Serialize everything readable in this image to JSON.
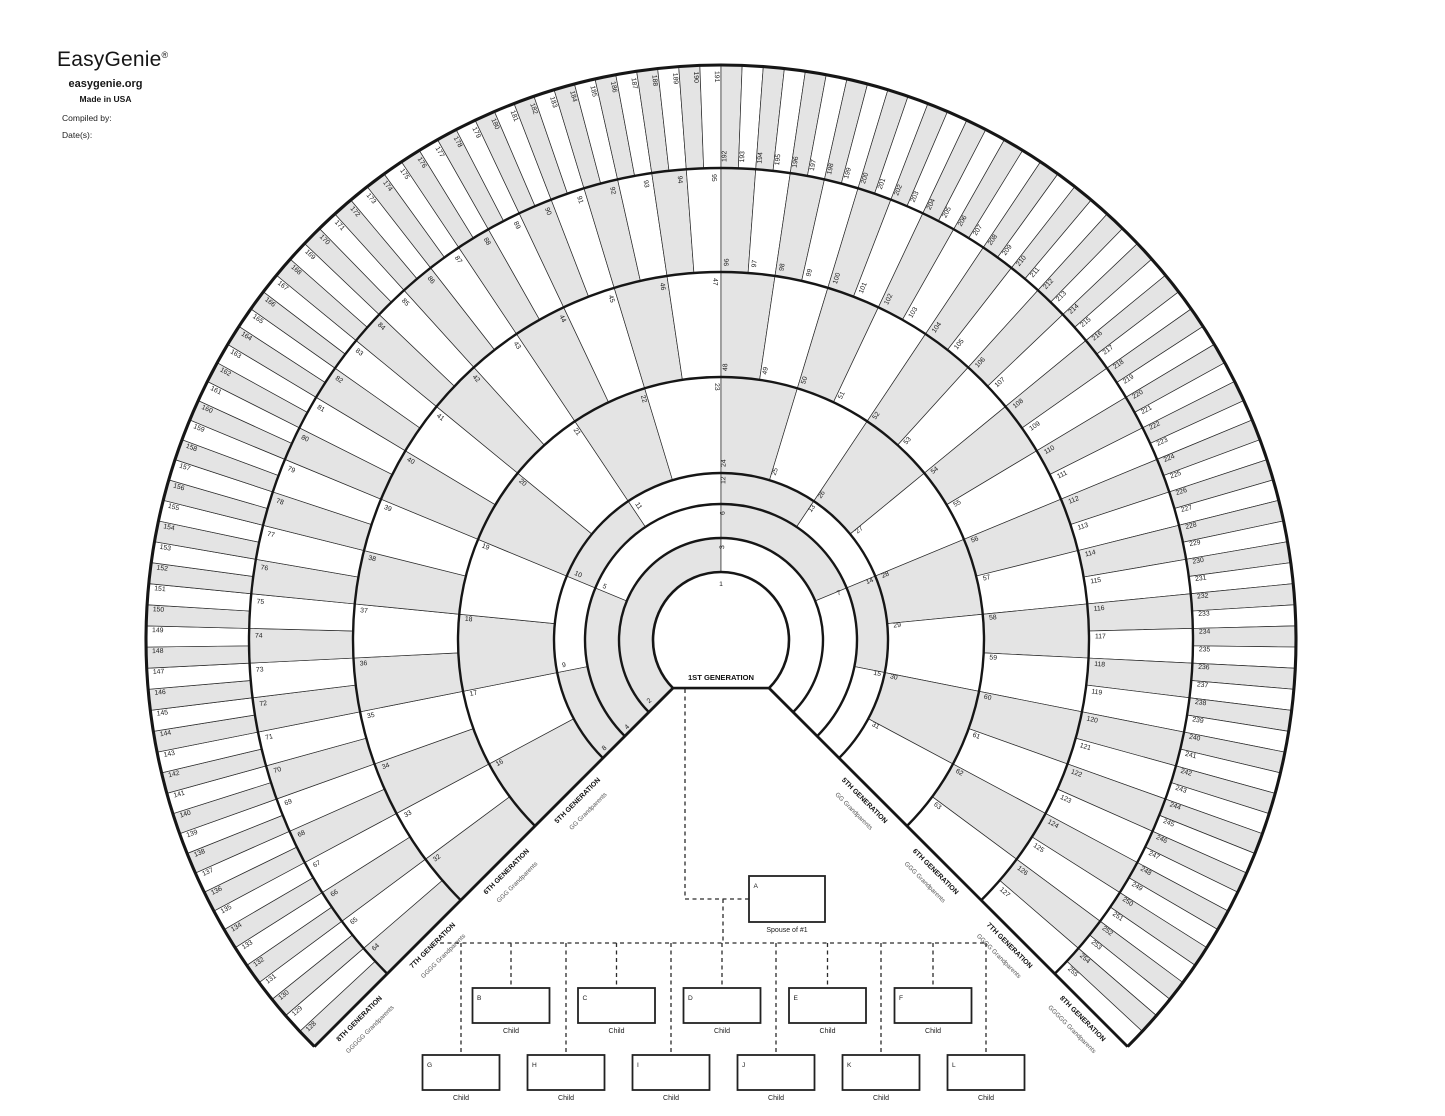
{
  "header": {
    "logo": "EasyGenie",
    "registered": "®",
    "site": "easygenie.org",
    "made_in": "Made in USA",
    "compiled_by": "Compiled by:",
    "dates": "Date(s):"
  },
  "fan": {
    "center_label": "1ST GENERATION",
    "center_number": "1",
    "colors": {
      "shade": "#e4e4e4",
      "line": "#161616",
      "subtext": "#555555"
    },
    "geometry": {
      "cx": 721,
      "cy": 640,
      "start_angle": 225,
      "end_angle": -45,
      "radii": [
        68,
        102,
        136,
        167,
        263,
        368,
        472,
        575
      ]
    },
    "rings": [
      {
        "generation": 2,
        "first": 2,
        "last": 3
      },
      {
        "generation": 3,
        "first": 4,
        "last": 7
      },
      {
        "generation": 4,
        "first": 8,
        "last": 15
      },
      {
        "generation": 5,
        "first": 16,
        "last": 31
      },
      {
        "generation": 6,
        "first": 32,
        "last": 63
      },
      {
        "generation": 7,
        "first": 64,
        "last": 127
      },
      {
        "generation": 8,
        "first": 128,
        "last": 255
      }
    ],
    "generation_edge_labels": [
      {
        "generation": 5,
        "title": "5TH GENERATION",
        "subtitle": "GG Grandparents"
      },
      {
        "generation": 6,
        "title": "6TH GENERATION",
        "subtitle": "GGG Grandparents"
      },
      {
        "generation": 7,
        "title": "7TH GENERATION",
        "subtitle": "GGGG Grandparents"
      },
      {
        "generation": 8,
        "title": "8TH GENERATION",
        "subtitle": "GGGGG Grandparents"
      }
    ]
  },
  "kinship": {
    "spouse": {
      "letter": "A",
      "caption": "Spouse of #1",
      "x": 749,
      "y": 876,
      "w": 76,
      "h": 46
    },
    "row1": {
      "y": 988,
      "w": 77,
      "h": 35,
      "items": [
        {
          "letter": "B",
          "caption": "Child",
          "cx": 511
        },
        {
          "letter": "C",
          "caption": "Child",
          "cx": 616.5
        },
        {
          "letter": "D",
          "caption": "Child",
          "cx": 722
        },
        {
          "letter": "E",
          "caption": "Child",
          "cx": 827.5
        },
        {
          "letter": "F",
          "caption": "Child",
          "cx": 933
        }
      ]
    },
    "row2": {
      "y": 1055,
      "w": 77,
      "h": 35,
      "items": [
        {
          "letter": "G",
          "caption": "Child",
          "cx": 461
        },
        {
          "letter": "H",
          "caption": "Child",
          "cx": 566
        },
        {
          "letter": "I",
          "caption": "Child",
          "cx": 671
        },
        {
          "letter": "J",
          "caption": "Child",
          "cx": 776
        },
        {
          "letter": "K",
          "caption": "Child",
          "cx": 881
        },
        {
          "letter": "L",
          "caption": "Child",
          "cx": 986
        }
      ]
    },
    "connectors": {
      "descent_x": 685,
      "marriage_y": 899,
      "couple_drop_x": 723,
      "sibling_line_y": 943,
      "sibling_x1": 440,
      "sibling_x2": 985
    }
  }
}
